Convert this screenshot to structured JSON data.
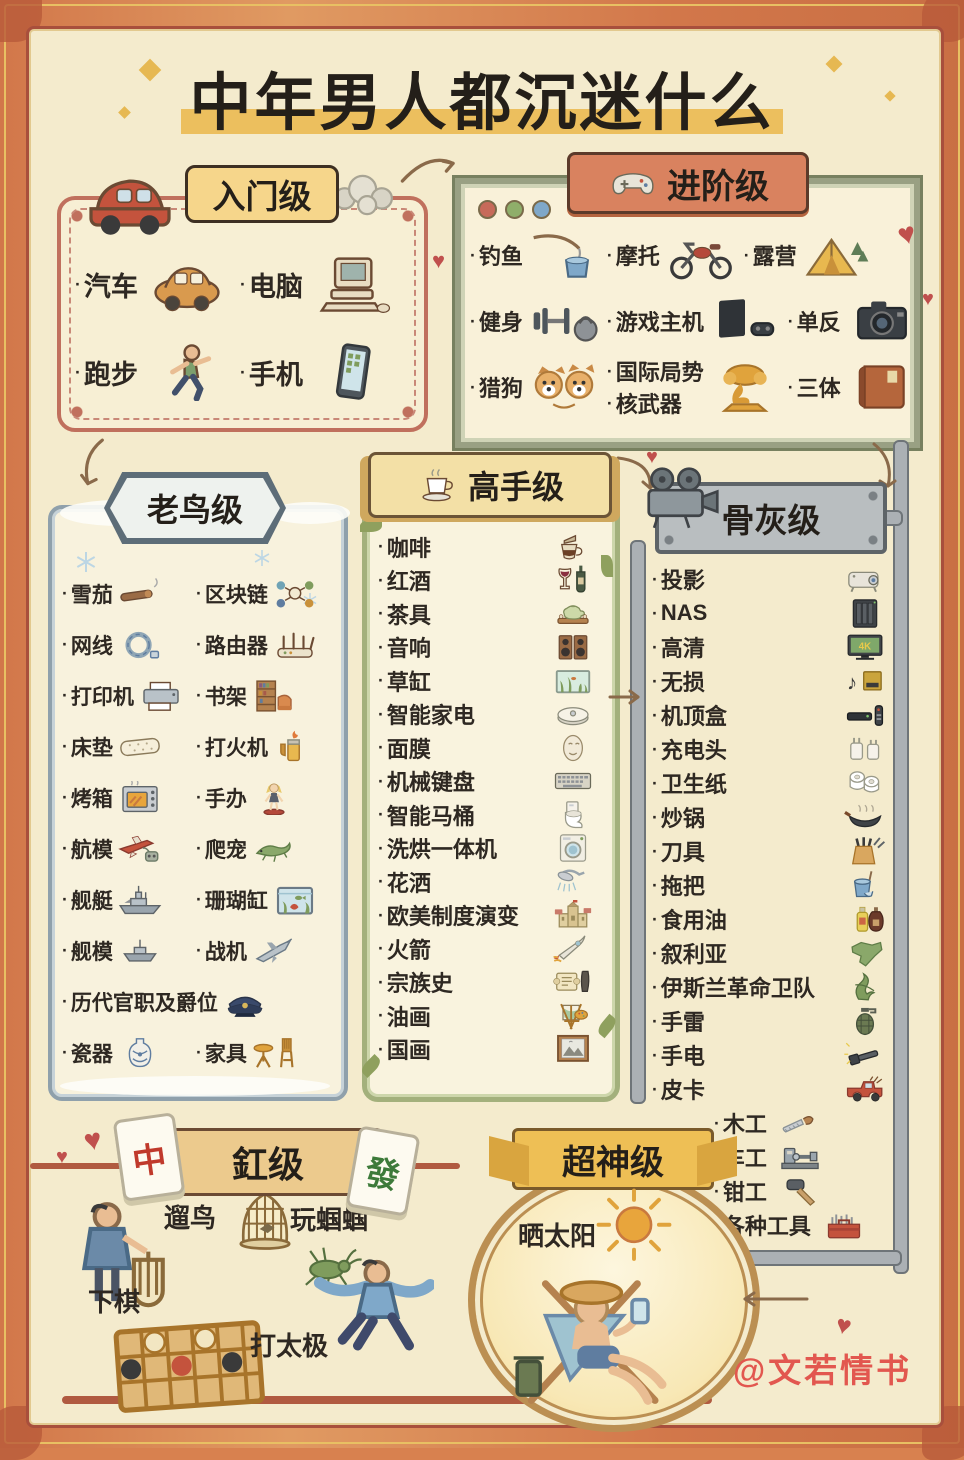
{
  "title": "中年男人都沉迷什么",
  "watermark": "@文若情书",
  "bullet": "·",
  "icons": {
    "heart": "♥"
  },
  "colors": {
    "paper": "#f4ebcd",
    "frame": "#d2774a",
    "title_highlight": "#ecbf5e",
    "entry_border": "#c0705d",
    "advanced_border": "#99a083",
    "veteran_border": "#8fa0ab",
    "expert_border": "#a3b07c",
    "hardcore_metal": "#b9bec0",
    "gang_banner": "#ecca8d",
    "supergod_gold": "#eebf55",
    "watermark_red": "#e2574f"
  },
  "sections": {
    "entry": {
      "label": "入门级",
      "items": [
        {
          "label": "汽车",
          "icon": "car-orange"
        },
        {
          "label": "电脑",
          "icon": "computer-retro"
        },
        {
          "label": "跑步",
          "icon": "runner"
        },
        {
          "label": "手机",
          "icon": "smartphone"
        }
      ]
    },
    "advanced": {
      "label": "进阶级",
      "rows": [
        [
          {
            "label": "钓鱼",
            "icon": "fishing"
          },
          {
            "label": "摩托",
            "icon": "motorcycle"
          },
          {
            "label": "露营",
            "icon": "tent"
          }
        ],
        [
          {
            "label": "健身",
            "icon": "fitness"
          },
          {
            "label": "游戏主机",
            "icon": "game-console"
          },
          {
            "label": "单反",
            "icon": "camera"
          }
        ],
        [
          {
            "label": "猎狗",
            "icon": "shiba-dogs"
          },
          {
            "labels": [
              "国际局势",
              "核武器"
            ],
            "icon": "mushroom-cloud"
          },
          {
            "label": "三体",
            "icon": "book"
          }
        ]
      ]
    },
    "veteran": {
      "label": "老鸟级",
      "items": [
        {
          "label": "雪茄",
          "icon": "cigar"
        },
        {
          "label": "区块链",
          "icon": "blockchain"
        },
        {
          "label": "网线",
          "icon": "cable-coil"
        },
        {
          "label": "路由器",
          "icon": "router"
        },
        {
          "label": "打印机",
          "icon": "printer"
        },
        {
          "label": "书架",
          "icon": "bookshelf"
        },
        {
          "label": "床垫",
          "icon": "mattress"
        },
        {
          "label": "打火机",
          "icon": "lighter"
        },
        {
          "label": "烤箱",
          "icon": "oven"
        },
        {
          "label": "手办",
          "icon": "figurine"
        },
        {
          "label": "航模",
          "icon": "rc-plane"
        },
        {
          "label": "爬宠",
          "icon": "lizard"
        },
        {
          "label": "舰艇",
          "icon": "warship"
        },
        {
          "label": "珊瑚缸",
          "icon": "fish-tank"
        },
        {
          "label": "舰模",
          "icon": "ship-model"
        },
        {
          "label": "战机",
          "icon": "fighter-jet"
        },
        {
          "label": "历代官职及爵位",
          "icon": "officer-cap",
          "wide": true
        },
        {
          "label": "瓷器",
          "icon": "porcelain-vase"
        },
        {
          "label": "家具",
          "icon": "furniture"
        }
      ]
    },
    "expert": {
      "label": "高手级",
      "items": [
        {
          "label": "咖啡",
          "icon": "pour-over-coffee"
        },
        {
          "label": "红酒",
          "icon": "wine"
        },
        {
          "label": "茶具",
          "icon": "tea-set"
        },
        {
          "label": "音响",
          "icon": "speakers"
        },
        {
          "label": "草缸",
          "icon": "planted-tank"
        },
        {
          "label": "智能家电",
          "icon": "robot-vacuum"
        },
        {
          "label": "面膜",
          "icon": "face-mask"
        },
        {
          "label": "机械键盘",
          "icon": "keyboard"
        },
        {
          "label": "智能马桶",
          "icon": "smart-toilet"
        },
        {
          "label": "洗烘一体机",
          "icon": "washer"
        },
        {
          "label": "花洒",
          "icon": "shower-head"
        },
        {
          "label": "欧美制度演变",
          "icon": "castle"
        },
        {
          "label": "火箭",
          "icon": "rocket"
        },
        {
          "label": "宗族史",
          "icon": "scroll"
        },
        {
          "label": "油画",
          "icon": "easel"
        },
        {
          "label": "国画",
          "icon": "painting"
        }
      ]
    },
    "hardcore": {
      "label": "骨灰级",
      "items": [
        {
          "label": "投影",
          "icon": "projector"
        },
        {
          "label": "NAS",
          "icon": "nas-server"
        },
        {
          "label": "高清",
          "icon": "tv-4k"
        },
        {
          "label": "无损",
          "icon": "music-album"
        },
        {
          "label": "机顶盒",
          "icon": "settop-box"
        },
        {
          "label": "充电头",
          "icon": "charger"
        },
        {
          "label": "卫生纸",
          "icon": "toilet-paper"
        },
        {
          "label": "炒锅",
          "icon": "wok"
        },
        {
          "label": "刀具",
          "icon": "knife-block"
        },
        {
          "label": "拖把",
          "icon": "mop-bucket"
        },
        {
          "label": "食用油",
          "icon": "oil-bottles"
        },
        {
          "label": "叙利亚",
          "icon": "syria-map"
        },
        {
          "label": "伊斯兰革命卫队",
          "icon": "green-emblem"
        },
        {
          "label": "手雷",
          "icon": "grenade"
        },
        {
          "label": "手电",
          "icon": "flashlight"
        },
        {
          "label": "皮卡",
          "icon": "pickup-truck"
        },
        {
          "label": "木工",
          "icon": "hand-saw",
          "indent": true
        },
        {
          "label": "车工",
          "icon": "lathe",
          "indent": true
        },
        {
          "label": "钳工",
          "icon": "mallet",
          "indent": true
        },
        {
          "label": "各种工具",
          "icon": "toolbox",
          "indent": true
        }
      ]
    },
    "gang": {
      "label": "釭级",
      "tiles": [
        "中",
        "發"
      ],
      "items": [
        {
          "label": "遛鸟",
          "icon": "man-birdcage"
        },
        {
          "label": "玩蝈蝈",
          "icon": "cricket"
        },
        {
          "label": "下棋",
          "icon": "chessboard"
        },
        {
          "label": "打太极",
          "icon": "taichi-man"
        }
      ]
    },
    "supergod": {
      "label": "超神级",
      "items": [
        {
          "label": "晒太阳",
          "icon": "sun"
        }
      ]
    }
  }
}
